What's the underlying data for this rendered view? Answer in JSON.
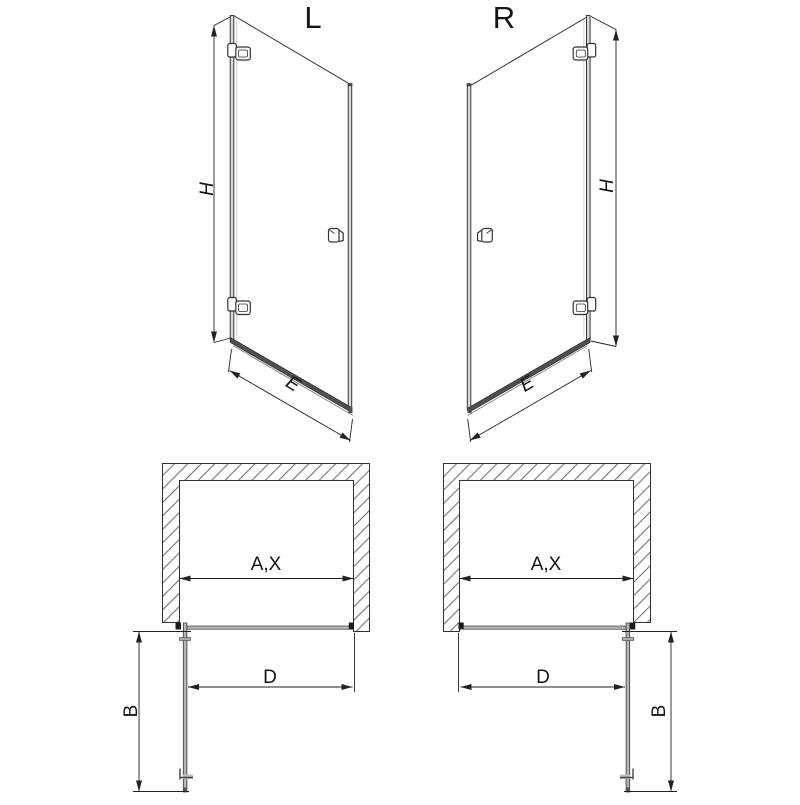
{
  "diagram": {
    "type": "technical-drawing",
    "subject": "hinged shower door installation drawing, left and right hand versions, perspective view and top (plan) view",
    "variants": {
      "left": "L",
      "right": "R"
    },
    "dimension_labels": {
      "height": "H",
      "bottom_width": "E",
      "opening_width": "A,X",
      "door_width": "D",
      "opening_depth": "B"
    },
    "colors": {
      "line": "#333333",
      "text": "#141414",
      "profile_dark": "#4f4f4f",
      "profile_light": "#b5b5b5",
      "background": "#ffffff"
    }
  }
}
